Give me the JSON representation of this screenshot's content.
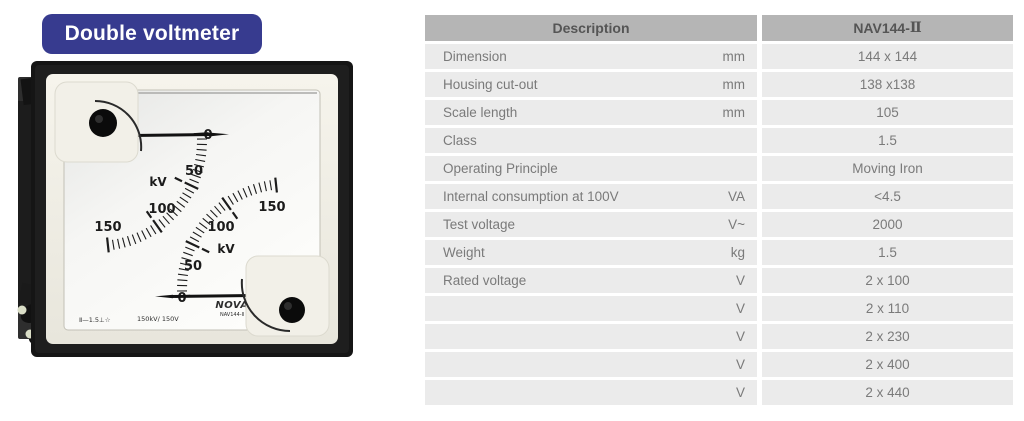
{
  "colors": {
    "badge_bg": "#373b8f",
    "table_header_bg": "#b5b5b5",
    "table_row_bg": "#ebebeb",
    "table_text": "#7a7a7a",
    "table_header_text": "#555555"
  },
  "badge": {
    "label": "Double voltmeter"
  },
  "meter": {
    "scale": {
      "ticks": [
        "0",
        "50",
        "100",
        "150"
      ],
      "unit": "kV"
    },
    "markings": {
      "symbols": "Ⅱ—1.5⊥☆",
      "range": "150kV/ 150V"
    },
    "brand": "NOVA",
    "model": "NAV144-Ⅱ"
  },
  "table": {
    "header": {
      "description": "Description",
      "model_prefix": "NAV144-",
      "model_suffix": "Ⅱ"
    },
    "rows": [
      {
        "label": "Dimension",
        "unit": "mm",
        "value": "144 x 144"
      },
      {
        "label": "Housing cut-out",
        "unit": "mm",
        "value": "138 x138"
      },
      {
        "label": "Scale length",
        "unit": "mm",
        "value": "105"
      },
      {
        "label": "Class",
        "unit": "",
        "value": "1.5"
      },
      {
        "label": "Operating Principle",
        "unit": "",
        "value": "Moving Iron"
      },
      {
        "label": "Internal consumption at 100V",
        "unit": "VA",
        "value": "<4.5"
      },
      {
        "label": "Test voltage",
        "unit": "V~",
        "value": "2000"
      },
      {
        "label": "Weight",
        "unit": "kg",
        "value": "1.5"
      },
      {
        "label": "Rated voltage",
        "unit": "V",
        "value": "2 x 100"
      },
      {
        "label": "",
        "unit": "V",
        "value": "2 x 110"
      },
      {
        "label": "",
        "unit": "V",
        "value": "2 x 230"
      },
      {
        "label": "",
        "unit": "V",
        "value": "2 x 400"
      },
      {
        "label": "",
        "unit": "V",
        "value": "2 x 440"
      }
    ]
  }
}
